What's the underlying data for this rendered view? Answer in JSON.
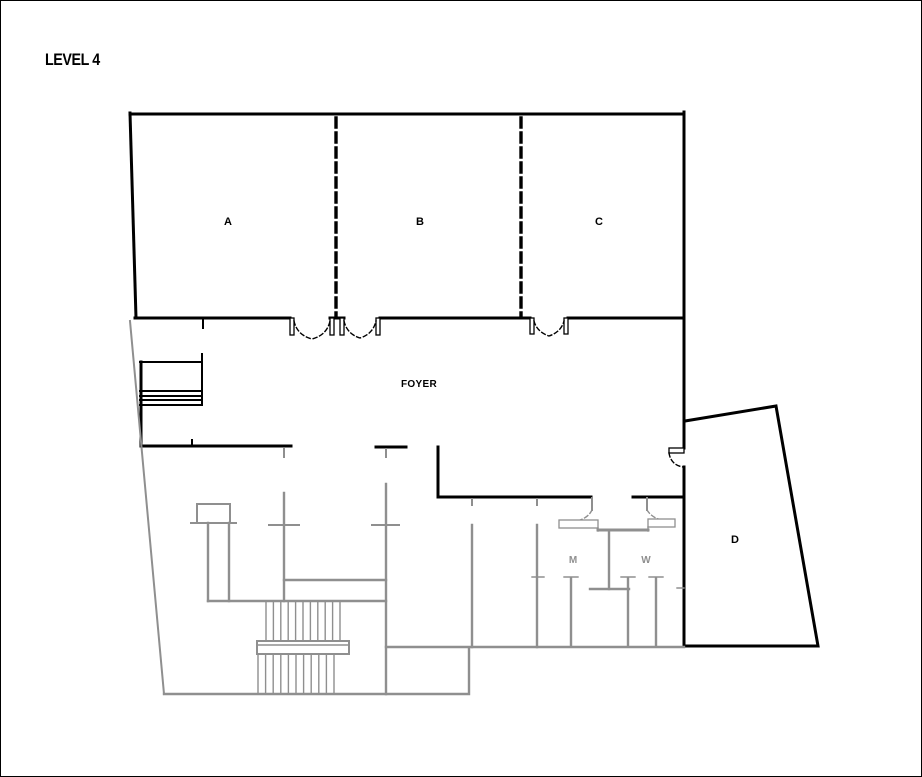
{
  "title": "LEVEL 4",
  "floor_plan": {
    "rooms": {
      "a": "A",
      "b": "B",
      "c": "C",
      "d": "D",
      "foyer": "FOYER",
      "mens": "M",
      "womens": "W"
    }
  },
  "colors": {
    "wall": "#000000",
    "lower_level": "#8f8f8f",
    "background": "#ffffff"
  }
}
